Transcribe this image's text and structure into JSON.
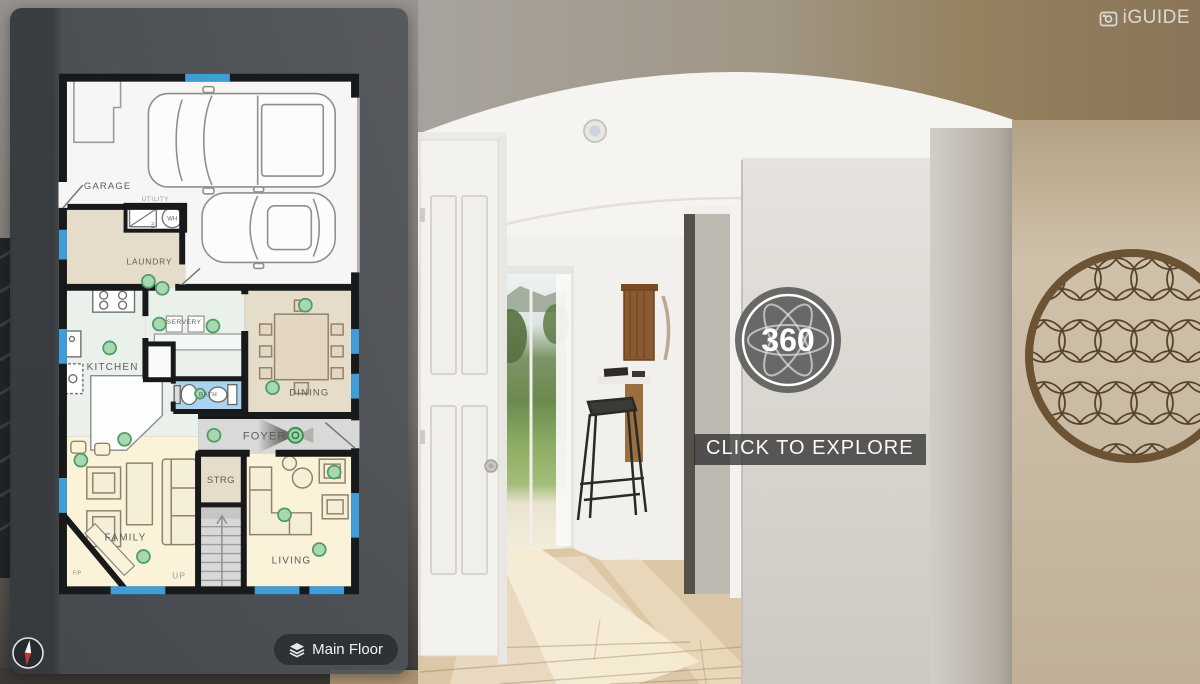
{
  "brand": {
    "logo_text": "iGUIDE"
  },
  "viewer": {
    "badge_label": "360",
    "explore_label": "CLICK TO EXPLORE"
  },
  "panel": {
    "floor_button_label": "Main Floor"
  },
  "floorplan": {
    "rooms": [
      {
        "label": "GARAGE"
      },
      {
        "label": "LAUNDRY"
      },
      {
        "label": "UTILITY"
      },
      {
        "label": "KITCHEN"
      },
      {
        "label": "SERVERY"
      },
      {
        "label": "DINING"
      },
      {
        "label": "BATH"
      },
      {
        "label": "FOYER"
      },
      {
        "label": "STRG"
      },
      {
        "label": "FAMILY"
      },
      {
        "label": "LIVING"
      }
    ],
    "annotations": {
      "stairs_up": "UP",
      "fireplace": "F/P",
      "water_heater": "WH",
      "furnace": "FN"
    },
    "colors": {
      "wall": "#17191b",
      "window": "#3f9dd8",
      "pano_marker_fill": "#a8d7b2",
      "pano_marker_stroke": "#4d9e66",
      "room_beige": "#e6dcca",
      "room_mint": "#e9f1ea",
      "room_yellow": "#faf3da",
      "room_blue": "#a9d3f0",
      "room_gray": "#d9d9d7"
    }
  }
}
